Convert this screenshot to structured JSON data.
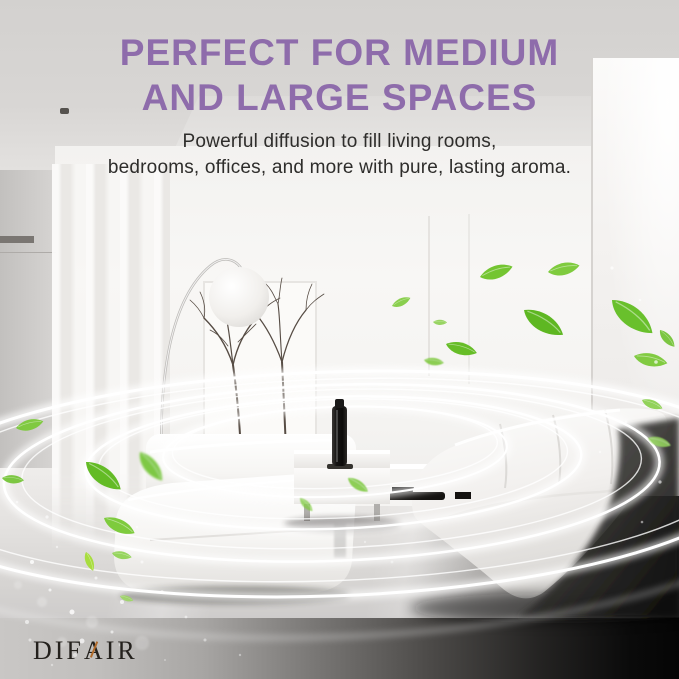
{
  "header": {
    "title_line1": "PERFECT FOR MEDIUM",
    "title_line2": "AND LARGE SPACES",
    "subtitle_line1": "Powerful diffusion to fill living rooms,",
    "subtitle_line2": "bedrooms, offices, and more with pure, lasting aroma."
  },
  "brand": {
    "logo_part1": "DIF",
    "logo_accent_letter": "A",
    "logo_part2": "IR",
    "logo_full": "DIFAIR"
  },
  "scene": {
    "colors": {
      "title_purple": "#8e6cab",
      "subtitle_gray": "#2e2d2b",
      "leaf_green": "#6abf2d",
      "leaf_green_light": "#9bd75f",
      "aroma_ring_white": "#ffffff",
      "ceiling_gray": "#d6d4d2",
      "wall_white": "#f6f5f3",
      "floor_gray": "#dcdad8",
      "bottom_band_black": "#0a0a0a",
      "diffuser_black": "#1a1918",
      "logo_accent_orange": "#b06a2a"
    }
  }
}
